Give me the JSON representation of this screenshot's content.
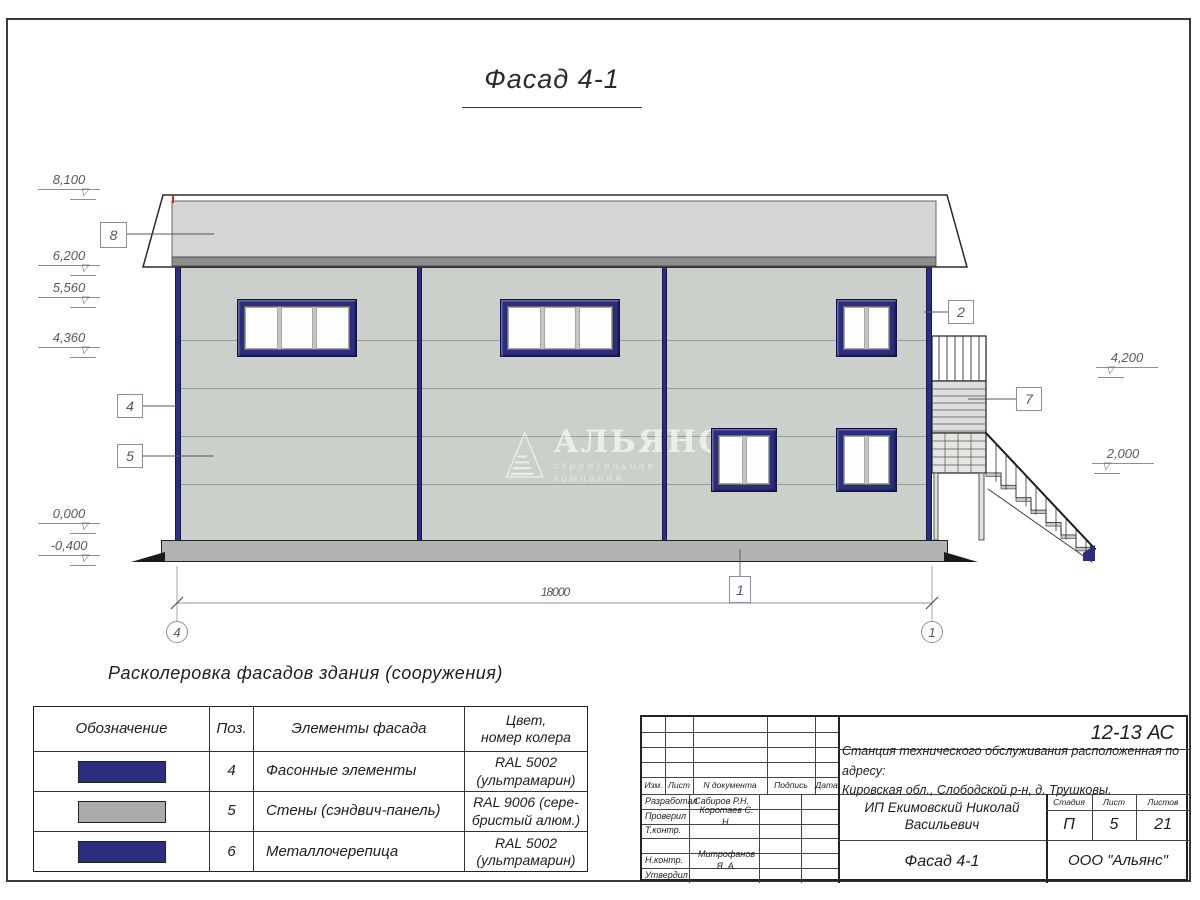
{
  "sheet": {
    "title": "Фасад 4-1"
  },
  "watermark": {
    "name": "АЛЬЯНС",
    "subtitle": "строительная компания"
  },
  "marks": {
    "left": [
      "8,100",
      "6,200",
      "5,560",
      "4,360",
      "0,000",
      "-0,400"
    ],
    "right": [
      "4,200",
      "2,000"
    ]
  },
  "callouts": {
    "roof": "8",
    "corner": "4",
    "wall": "5",
    "window": "2",
    "stair": "7",
    "plinth": "1"
  },
  "axes": {
    "left": "4",
    "right": "1"
  },
  "dimension": {
    "length": "18000"
  },
  "legend": {
    "heading": "Расколеровка фасадов здания (сооружения)",
    "columns": [
      "Обозначение",
      "Поз.",
      "Элементы фасада",
      "Цвет,\nномер колера"
    ],
    "rows": [
      {
        "pos": "4",
        "element": "Фасонные элементы",
        "color": "RAL 5002\n(ультрамарин)",
        "swatch": "#2b2e7e"
      },
      {
        "pos": "5",
        "element": "Стены (сэндвич-панель)",
        "color": "RAL 9006 (сере-\nбристый алюм.)",
        "swatch": "#a9aca9"
      },
      {
        "pos": "6",
        "element": "Металлочерепица",
        "color": "RAL 5002\n(ультрамарин)",
        "swatch": "#2b2e7e"
      }
    ]
  },
  "titleblock": {
    "code": "12-13 АС",
    "project_line1": "Станция технического обслуживания расположенная по адресу:",
    "project_line2": "Кировская обл., Слободской р-н, д. Трушковы.",
    "rev_cols": [
      "Изм.",
      "Лист",
      "N документа",
      "Подпись",
      "Дата"
    ],
    "rows": [
      {
        "role": "Разработал",
        "person": "Сабиров Р.Н."
      },
      {
        "role": "Проверил",
        "person": "Коротаев С. Н."
      },
      {
        "role": "Т.контр.",
        "person": ""
      },
      {
        "role": "",
        "person": ""
      },
      {
        "role": "Н.контр.",
        "person": "Митрофанов Я. А."
      },
      {
        "role": "Утвердил",
        "person": ""
      }
    ],
    "client": "ИП Екимовский Николай Васильевич",
    "stage_cols": [
      "Стадия",
      "Лист",
      "Листов"
    ],
    "stage": "П",
    "sheet_no": "5",
    "sheets_total": "21",
    "drawing_name": "Фасад 4-1",
    "company": "ООО \"Альянс\""
  },
  "colors": {
    "accent_navy": "#2b2e7e",
    "wall_gray": "#cbd1ca",
    "roof_gray": "#d4d6d3",
    "swatch_gray": "#a9aca9",
    "ral_5002": "RAL 5002",
    "ral_9006": "RAL 9006"
  }
}
